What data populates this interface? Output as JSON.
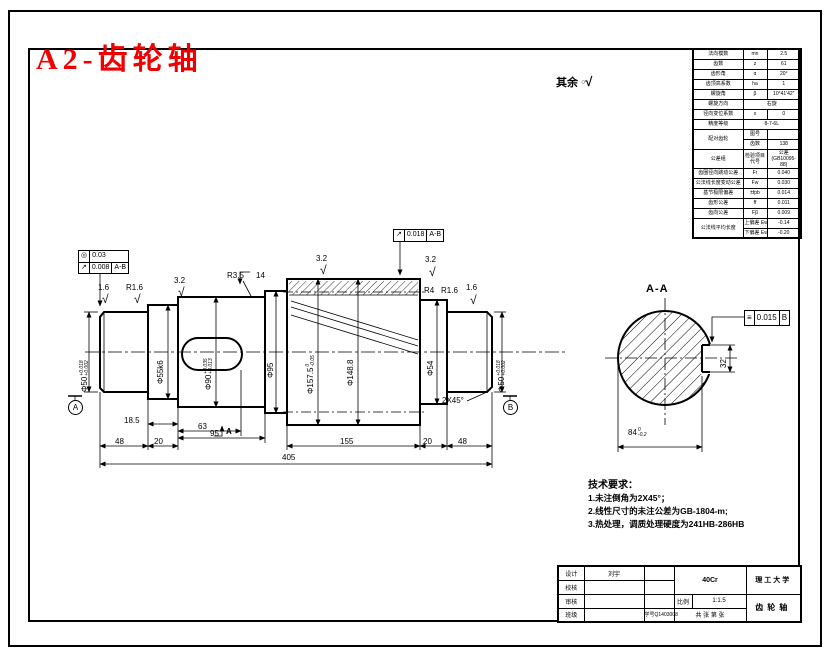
{
  "title": "A2-齿轮轴",
  "colors": {
    "title_red": "#f00000",
    "line": "#000000"
  },
  "icons": {
    "roughness_mark": "√",
    "rest_circle": "○"
  },
  "rest_note": {
    "label": "其余"
  },
  "gear_table": {
    "rows": [
      {
        "label": "法向模数",
        "sym": "mn",
        "val": "2.5"
      },
      {
        "label": "齿数",
        "sym": "z",
        "val": "61"
      },
      {
        "label": "齿形角",
        "sym": "α",
        "val": "20°"
      },
      {
        "label": "齿顶高系数",
        "sym": "ha",
        "val": "1"
      },
      {
        "label": "螺旋角",
        "sym": "β",
        "val": "10°41′42″"
      },
      {
        "label": "螺旋方向",
        "val": "右旋"
      },
      {
        "label": "径向变位系数",
        "sym": "x",
        "val": "0"
      },
      {
        "label": "精度等级",
        "val": "8-7-6L"
      },
      {
        "label": "配对齿轮",
        "sub1": "图号",
        "v1": "",
        "sub2": "齿数",
        "v2": "138"
      },
      {
        "label": "公差组",
        "mid": "检验项目代号",
        "right": "公差 (GB10095-88)"
      },
      {
        "label": "齿圈径向跳动公差",
        "sym": "Fr",
        "val": "0.040"
      },
      {
        "label": "公法线长度变动公差",
        "sym": "Fw",
        "val": "0.030"
      },
      {
        "label": "基节极限偏差",
        "sym": "±fpb",
        "val": "0.014"
      },
      {
        "label": "齿形公差",
        "sym": "ff",
        "val": "0.011"
      },
      {
        "label": "齿向公差",
        "sym": "Fβ",
        "val": "0.009"
      },
      {
        "label": "公法线平均长度",
        "sub1": "上偏差",
        "s1": "Ews",
        "v1": "-0.14",
        "sub2": "下偏差",
        "s2": "Ewi",
        "v2": "-0.20"
      }
    ]
  },
  "front_view": {
    "dims": {
      "d48_left": "48",
      "d20_left": "20",
      "d18_5": "18.5",
      "d63": "63",
      "d95": "95",
      "d155": "155",
      "d20_right": "20",
      "d48_right": "48",
      "overall": "405",
      "phi50_left": {
        "v": "Φ50",
        "up": "+0.018",
        "lo": "+0.002"
      },
      "phi55": "Φ55k6",
      "phi90": {
        "v": "Φ90",
        "up": "+0.035",
        "lo": "+0.013"
      },
      "phi95": "Φ95",
      "phi157": {
        "v": "Φ157.5",
        "up": "0",
        "lo": "-0.05"
      },
      "phi148": "Φ148.8",
      "phi54": "Φ54",
      "phi50_right": {
        "v": "Φ50",
        "up": "+0.018",
        "lo": "+0.002"
      },
      "chamfer": "2X45°",
      "section_label": "A"
    },
    "roughness": {
      "left_journal": "1.6",
      "left_fillet": "R1.6",
      "step": "3.2",
      "fillet_r35": "R3.5",
      "ring_width": "14",
      "gear_left": "3.2",
      "gear_right": "3.2",
      "fillet_r4": "R4",
      "fillet_r16": "R1.6",
      "right_journal": "1.6"
    },
    "fcf_left": {
      "row1": {
        "sym": "◎",
        "val": "0.03"
      },
      "row2": {
        "sym": "↗",
        "val": "0.008",
        "datum": "A-B"
      }
    },
    "fcf_gear": {
      "sym": "↗",
      "val": "0.018",
      "datum": "A-B"
    },
    "datum_a": "A",
    "datum_b": "B"
  },
  "section_view": {
    "title": "A-A",
    "fcf": {
      "sym": "≡",
      "val": "0.015",
      "datum": "B"
    },
    "width": "32",
    "dim84": {
      "v": "84",
      "up": "0",
      "lo": "-0.2"
    }
  },
  "tech_req": {
    "heading": "技术要求：",
    "items": [
      "1.未注倒角为2X45°；",
      "2.线性尺寸的未注公差为GB-1804-m;",
      "3.热处理，调质处理硬度为241HB-286HB"
    ]
  },
  "title_block": {
    "design_label": "设计",
    "designer": "刘宇",
    "check_label": "校核",
    "audit_label": "审核",
    "class_label": "班级",
    "student_id_label": "学号",
    "student_id": "Q1403008",
    "material": "40Cr",
    "scale_label": "比例",
    "scale": "1:1.5",
    "sheet_note": "共 张 第 张",
    "school": "理工大学",
    "part_name": "齿轮轴"
  }
}
